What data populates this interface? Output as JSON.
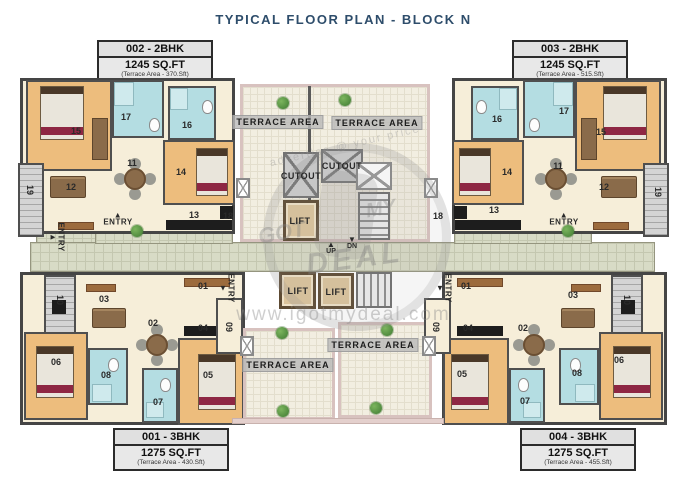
{
  "title": "TYPICAL FLOOR PLAN - BLOCK N",
  "units": [
    {
      "name": "002 - 2BHK",
      "area": "1245 SQ.FT",
      "terrace": "(Terrace Area - 370.Sft)"
    },
    {
      "name": "003 - 2BHK",
      "area": "1245 SQ.FT",
      "terrace": "(Terrace Area - 515.Sft)"
    },
    {
      "name": "001 - 3BHK",
      "area": "1275 SQ.FT",
      "terrace": "(Terrace Area - 430.Sft)"
    },
    {
      "name": "004 - 3BHK",
      "area": "1275 SQ.FT",
      "terrace": "(Terrace Area - 455.Sft)"
    }
  ],
  "labels": {
    "rooms": [
      {
        "t": "15",
        "x": 76,
        "y": 131
      },
      {
        "t": "17",
        "x": 126,
        "y": 117
      },
      {
        "t": "16",
        "x": 187,
        "y": 125
      },
      {
        "t": "11",
        "x": 132,
        "y": 163
      },
      {
        "t": "12",
        "x": 71,
        "y": 187
      },
      {
        "t": "14",
        "x": 181,
        "y": 172
      },
      {
        "t": "13",
        "x": 194,
        "y": 215
      },
      {
        "t": "19",
        "x": 30,
        "y": 190,
        "v": 1
      },
      {
        "t": "18",
        "x": 228,
        "y": 216
      },
      {
        "t": "16",
        "x": 497,
        "y": 119
      },
      {
        "t": "17",
        "x": 564,
        "y": 111
      },
      {
        "t": "15",
        "x": 601,
        "y": 132
      },
      {
        "t": "14",
        "x": 507,
        "y": 172
      },
      {
        "t": "11",
        "x": 558,
        "y": 166
      },
      {
        "t": "12",
        "x": 604,
        "y": 187
      },
      {
        "t": "13",
        "x": 494,
        "y": 210
      },
      {
        "t": "19",
        "x": 658,
        "y": 192,
        "v": 1
      },
      {
        "t": "18",
        "x": 438,
        "y": 216
      },
      {
        "t": "01",
        "x": 203,
        "y": 286
      },
      {
        "t": "03",
        "x": 104,
        "y": 299
      },
      {
        "t": "10",
        "x": 60,
        "y": 300,
        "v": 1
      },
      {
        "t": "02",
        "x": 153,
        "y": 323
      },
      {
        "t": "04",
        "x": 203,
        "y": 328
      },
      {
        "t": "06",
        "x": 56,
        "y": 362
      },
      {
        "t": "08",
        "x": 106,
        "y": 375
      },
      {
        "t": "05",
        "x": 208,
        "y": 375
      },
      {
        "t": "07",
        "x": 158,
        "y": 402
      },
      {
        "t": "09",
        "x": 229,
        "y": 327,
        "v": 1
      },
      {
        "t": "01",
        "x": 466,
        "y": 286
      },
      {
        "t": "03",
        "x": 573,
        "y": 295
      },
      {
        "t": "10",
        "x": 627,
        "y": 300,
        "v": 1
      },
      {
        "t": "02",
        "x": 523,
        "y": 328
      },
      {
        "t": "04",
        "x": 468,
        "y": 328
      },
      {
        "t": "06",
        "x": 619,
        "y": 360
      },
      {
        "t": "08",
        "x": 577,
        "y": 373
      },
      {
        "t": "05",
        "x": 462,
        "y": 374
      },
      {
        "t": "07",
        "x": 525,
        "y": 401
      },
      {
        "t": "09",
        "x": 436,
        "y": 327,
        "v": 1
      }
    ],
    "areas": [
      {
        "t": "TERRACE AREA",
        "x": 278,
        "y": 122
      },
      {
        "t": "TERRACE AREA",
        "x": 377,
        "y": 123
      },
      {
        "t": "TERRACE AREA",
        "x": 288,
        "y": 365
      },
      {
        "t": "TERRACE AREA",
        "x": 373,
        "y": 345
      }
    ],
    "core": [
      {
        "t": "CUTOUT",
        "x": 301,
        "y": 176
      },
      {
        "t": "CUTOUT",
        "x": 342,
        "y": 166
      },
      {
        "t": "LIFT",
        "x": 300,
        "y": 221
      },
      {
        "t": "LIFT",
        "x": 298,
        "y": 291
      },
      {
        "t": "LIFT",
        "x": 336,
        "y": 292
      }
    ],
    "updn": [
      {
        "t": "UP",
        "x": 331,
        "y": 248,
        "a": "▲"
      },
      {
        "t": "DN",
        "x": 352,
        "y": 243,
        "a": "▼"
      }
    ],
    "entries": [
      {
        "t": "ENTRY",
        "x": 118,
        "y": 219,
        "a": "▲"
      },
      {
        "t": "ENTRY",
        "x": 564,
        "y": 219,
        "a": "▲"
      },
      {
        "t": "ENTRY",
        "x": 57,
        "y": 237,
        "v": 1,
        "a": "►"
      },
      {
        "t": "ENTRY",
        "x": 227,
        "y": 288,
        "v": 1,
        "a": "▼"
      },
      {
        "t": "ENTRY",
        "x": 444,
        "y": 288,
        "v": 1,
        "a": "▼"
      }
    ]
  },
  "watermark": {
    "brand_got": "GOT",
    "brand_my": "MY",
    "brand_deal": "DEAL",
    "tagline": "advertise @ your price",
    "site": "www.igotmydeal.com"
  },
  "colors": {
    "title": "#2e4d6b",
    "bedroom_floor": "#edbd7d",
    "living_floor": "#f6eed9",
    "bath_floor": "#b4dde2",
    "corridor_floor": "#d8dbc6",
    "terrace_floor": "#f2eee1",
    "terrace_wall": "#d8c2bf",
    "lift_floor": "#dcc49c",
    "accent_maroon": "#8e2743",
    "plant_green": "#3e7a32",
    "wall": "#4f4f4f"
  }
}
